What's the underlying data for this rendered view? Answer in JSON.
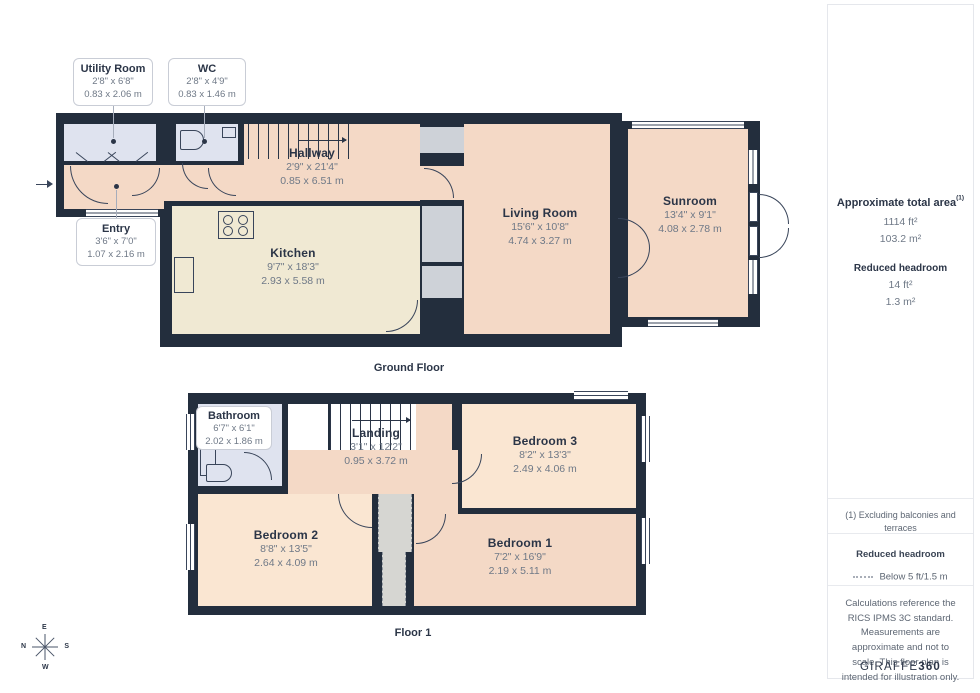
{
  "ground": {
    "label": "Ground Floor",
    "callouts": {
      "utility": {
        "name": "Utility Room",
        "imperial": "2'8\" x 6'8\"",
        "metric": "0.83 x 2.06 m"
      },
      "wc": {
        "name": "WC",
        "imperial": "2'8\" x 4'9\"",
        "metric": "0.83 x 1.46 m"
      },
      "entry": {
        "name": "Entry",
        "imperial": "3'6\" x 7'0\"",
        "metric": "1.07 x 2.16 m"
      }
    },
    "rooms": {
      "hallway": {
        "name": "Hallway",
        "imperial": "2'9\" x 21'4\"",
        "metric": "0.85 x 6.51 m"
      },
      "kitchen": {
        "name": "Kitchen",
        "imperial": "9'7\" x 18'3\"",
        "metric": "2.93 x 5.58 m"
      },
      "living": {
        "name": "Living Room",
        "imperial": "15'6\" x 10'8\"",
        "metric": "4.74 x 3.27 m"
      },
      "sunroom": {
        "name": "Sunroom",
        "imperial": "13'4\" x 9'1\"",
        "metric": "4.08 x 2.78 m"
      }
    }
  },
  "first": {
    "label": "Floor 1",
    "callouts": {
      "bathroom": {
        "name": "Bathroom",
        "imperial": "6'7\" x 6'1\"",
        "metric": "2.02 x 1.86 m"
      }
    },
    "rooms": {
      "landing": {
        "name": "Landing",
        "imperial": "3'1\" x 12'2\"",
        "metric": "0.95 x 3.72 m"
      },
      "bedroom3": {
        "name": "Bedroom 3",
        "imperial": "8'2\" x 13'3\"",
        "metric": "2.49 x 4.06 m"
      },
      "bedroom2": {
        "name": "Bedroom 2",
        "imperial": "8'8\" x 13'5\"",
        "metric": "2.64 x 4.09 m"
      },
      "bedroom1": {
        "name": "Bedroom 1",
        "imperial": "7'2\" x 16'9\"",
        "metric": "2.19 x 5.11 m"
      }
    }
  },
  "sidebar": {
    "total_area_label": "Approximate total area",
    "total_area_footnote": "(1)",
    "total_area_ft": "1114 ft²",
    "total_area_m": "103.2 m²",
    "reduced_headroom_label": "Reduced headroom",
    "reduced_headroom_ft": "14 ft²",
    "reduced_headroom_m": "1.3 m²",
    "footnote": "(1) Excluding balconies and terraces",
    "legend_title": "Reduced headroom",
    "legend_value": "Below 5 ft/1.5 m",
    "disclaimer": "Calculations reference the RICS IPMS 3C standard. Measurements are approximate and not to scale. This floor plan is intended for illustration only.",
    "brand": "GIRAFFE",
    "brand_suffix": "360"
  },
  "compass": {
    "top": "E",
    "left": "N",
    "right": "S",
    "bottom": "W"
  },
  "colors": {
    "wall": "#232e3d",
    "peach": "#f4d9c6",
    "light_peach": "#fae6d2",
    "blue": "#dfe3ef",
    "cream": "#f0e9d3"
  }
}
